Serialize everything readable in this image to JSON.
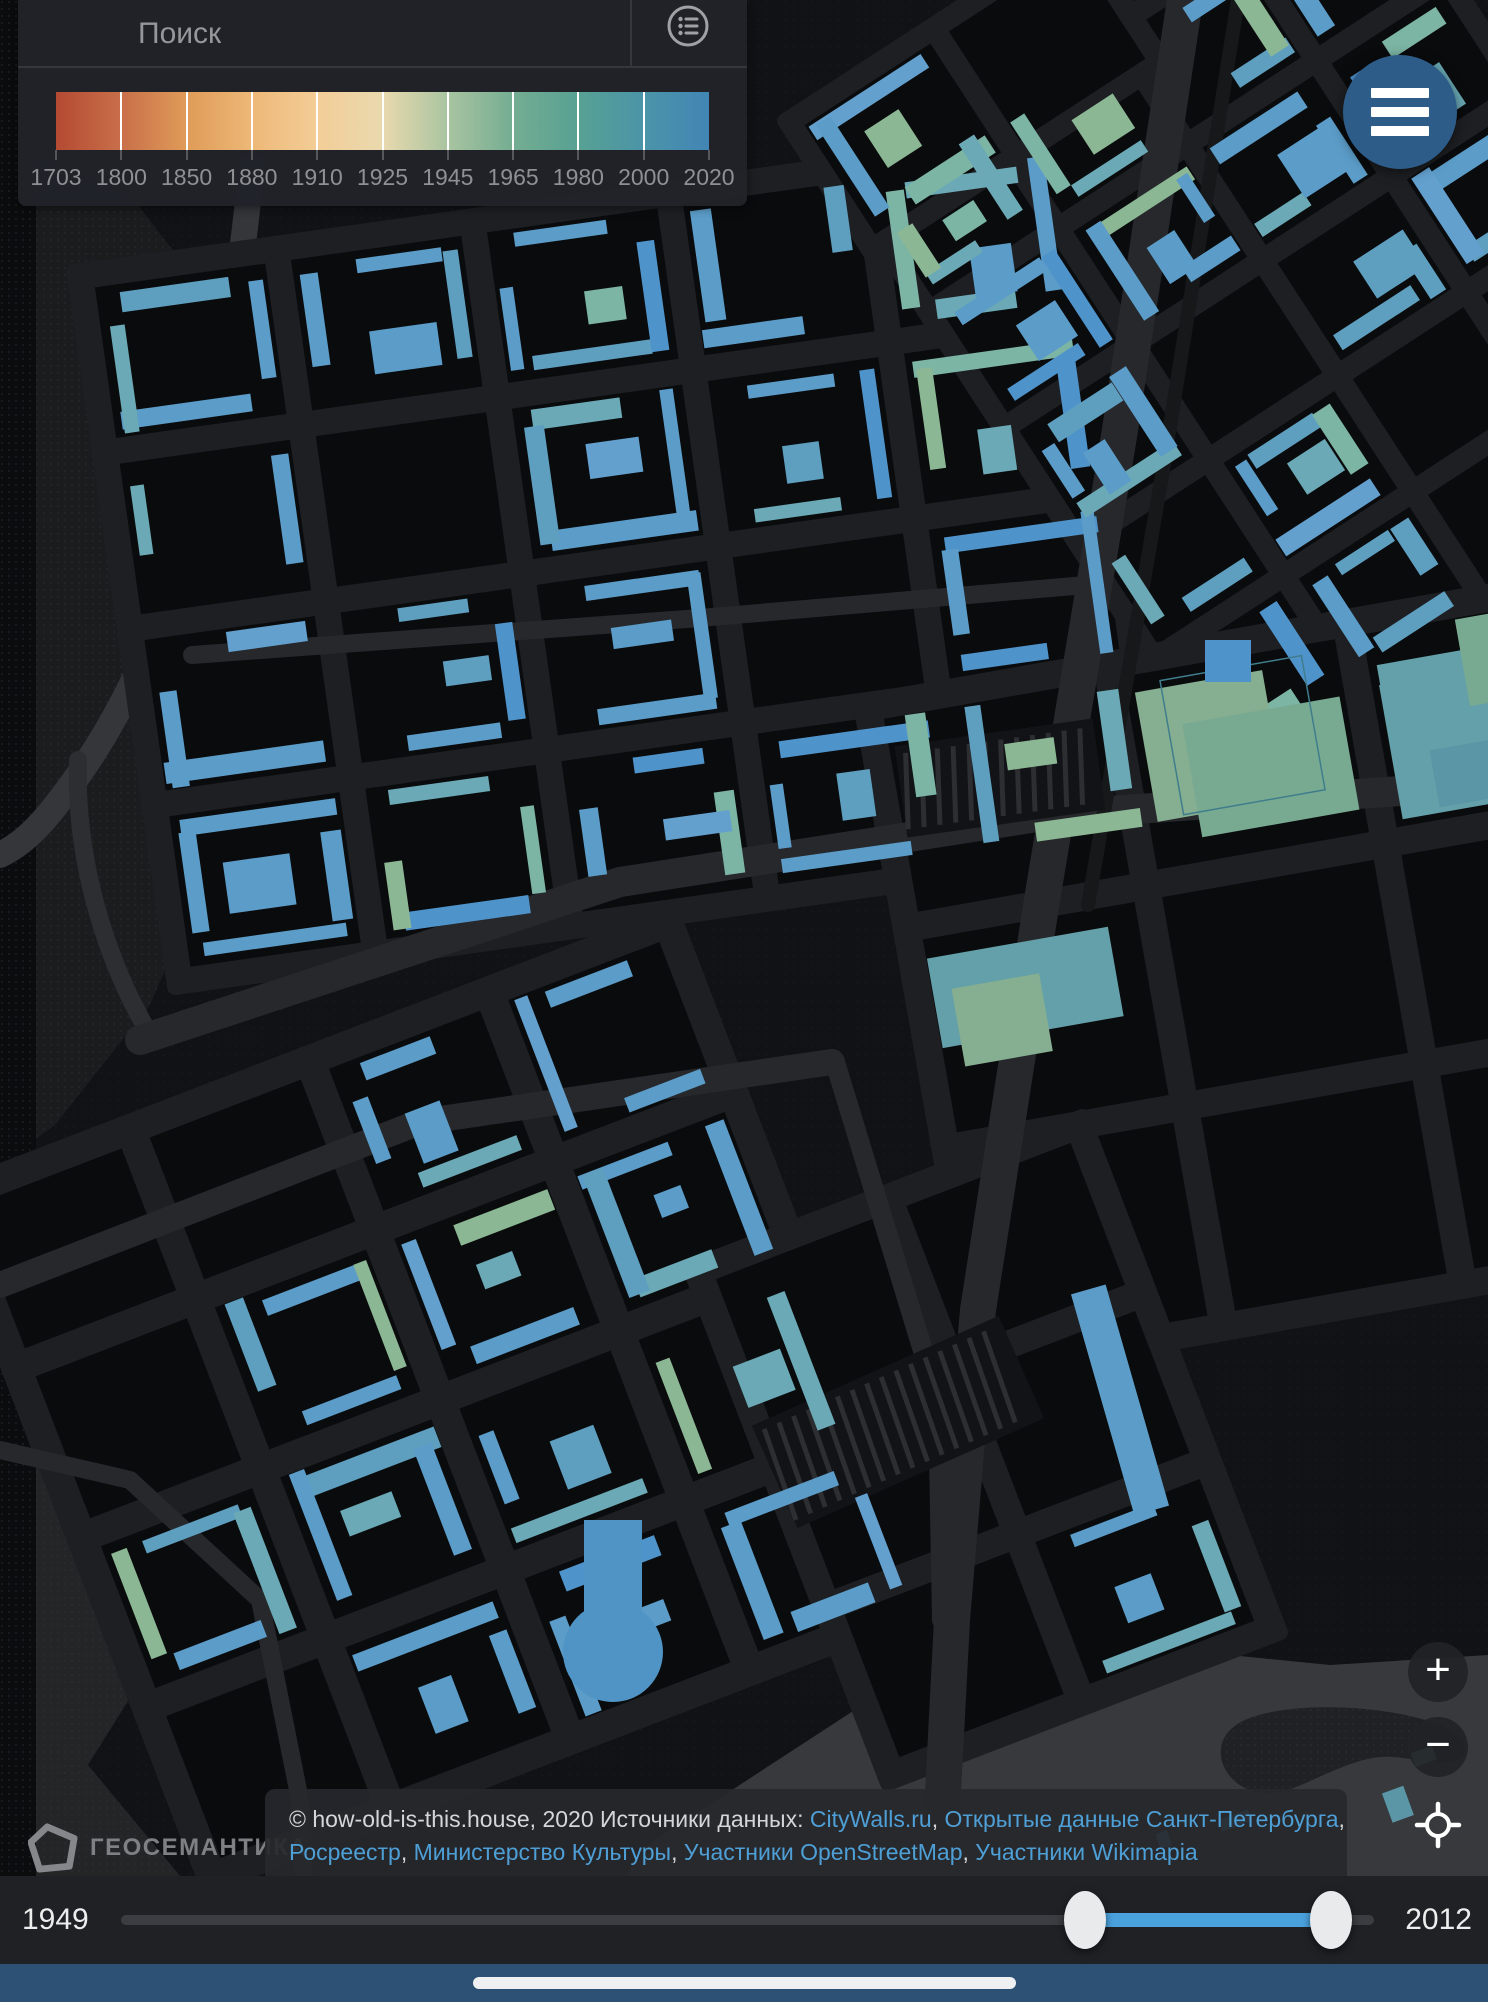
{
  "search": {
    "placeholder": "Поиск"
  },
  "legend": {
    "years": [
      "1703",
      "1800",
      "1850",
      "1880",
      "1910",
      "1925",
      "1945",
      "1965",
      "1980",
      "2000",
      "2020"
    ],
    "gradient": [
      "#b44a32",
      "#c96f4a",
      "#e09b58",
      "#edb877",
      "#f3cd97",
      "#e9d9ae",
      "#a9c4a0",
      "#74ad92",
      "#57a193",
      "#4b94a8",
      "#4285b5"
    ]
  },
  "controls": {
    "zoom_in": "+",
    "zoom_out": "−"
  },
  "menu_button": {
    "color": "#2d5c88"
  },
  "logo": {
    "text": "ГЕОСЕМАНТИКА"
  },
  "attribution": {
    "lines": [
      [
        {
          "t": "© how-old-is-this.house, 2020 Источники данных: ",
          "link": false
        },
        {
          "t": "CityWalls.ru",
          "link": true
        },
        {
          "t": ", ",
          "link": false
        },
        {
          "t": "Открытые данные Санкт-Петербурга",
          "link": true
        },
        {
          "t": ",",
          "link": false
        }
      ],
      [
        {
          "t": "Росреестр",
          "link": true
        },
        {
          "t": ", ",
          "link": false
        },
        {
          "t": "Министерство Культуры",
          "link": true
        },
        {
          "t": ", ",
          "link": false
        },
        {
          "t": "Участники OpenStreetMap",
          "link": true
        },
        {
          "t": ", ",
          "link": false
        },
        {
          "t": "Участники Wikimapia",
          "link": true
        }
      ]
    ]
  },
  "timeline": {
    "min_label": "1949",
    "max_label": "2012",
    "handle_pct": [
      76.9,
      96.6
    ],
    "active_color": "#4aa2dd"
  },
  "home_strip_color": "#2d5174",
  "map": {
    "seed": 1337,
    "colors": {
      "base": "#111215",
      "backing": "#1d1f22",
      "block": "#0a0b0d",
      "road": "#26282c",
      "rail": "#17181a",
      "hatch_bg": "#121316",
      "hatch_line": "#2c2e31",
      "dots": "#2e3033",
      "buildings": [
        "#5b9cc8",
        "#5e9fc0",
        "#6aa9b5",
        "#7cb5a4",
        "#4f93cb",
        "#8cb794",
        "#63a0ce"
      ],
      "building_weights": [
        46,
        16,
        12,
        8,
        8,
        5,
        5
      ],
      "industrial": [
        "#64a0a9",
        "#5a96a6",
        "#4f93c9",
        "#78aa92",
        "#86ae90",
        "#5b9cc8"
      ],
      "outline": "#3f7d8c"
    },
    "terrains": [
      {
        "pts": "0,140 130,195 235,330 272,560 238,800 150,1005 55,1125 0,1165",
        "fill": "#1a1c1e",
        "dots": true
      },
      {
        "pts": "0,1200 150,1262 232,1402 188,1605 88,1765 0,1805",
        "fill": "#232527",
        "dots": true
      },
      {
        "pts": "560,2002 640,1850 870,1700 1130,1645 1330,1665 1488,1655 1488,2002",
        "fill": "#38393c",
        "dots": false
      },
      {
        "pts": "0,1805 88,1765 200,1900 140,2002 0,2002",
        "fill": "#232527",
        "dots": true
      },
      {
        "pts": "0,0 36,0 36,2002 0,2002",
        "fill": "#0b0c0e",
        "dots": true
      }
    ],
    "ponds": [
      {
        "d": "M1245,1720 C1290,1700 1390,1705 1440,1725 C1480,1742 1470,1768 1430,1762 C1390,1756 1380,1752 1340,1768 C1300,1784 1280,1800 1250,1790 C1220,1780 1205,1738 1245,1720 Z",
        "fill": "#1f2124"
      }
    ],
    "bands": [
      {
        "d": "M252,165 C225,420 185,640 60,800 C30,840 10,850 0,855",
        "color": "#34363a",
        "w": 26
      },
      {
        "d": "M150,1035 C100,950 75,850 78,760",
        "color": "#2c2e31",
        "w": 18
      }
    ],
    "roads": [
      {
        "pts": "140,1040 620,882 1050,815 1488,785",
        "w": 30
      },
      {
        "pts": "1185,0 1120,430 1042,900 978,1310 952,1620 942,1812",
        "w": 36
      },
      {
        "pts": "0,1285 420,1122 832,1062",
        "w": 26
      },
      {
        "pts": "192,655 700,618 1086,585",
        "w": 18
      },
      {
        "pts": "835,1062 938,1400 942,1620",
        "w": 20
      },
      {
        "pts": "0,1450 130,1480 260,1600 300,1800 310,2002",
        "w": 18
      }
    ],
    "rail": {
      "pts": "1238,0 1163,470 1088,905",
      "w": 14
    },
    "yards": [
      {
        "cx": 1000,
        "cy": 778,
        "w": 200,
        "h": 92,
        "rot": -8
      },
      {
        "cx": 898,
        "cy": 1422,
        "w": 270,
        "h": 112,
        "rot": -24
      }
    ],
    "districts": [
      {
        "cx": 620,
        "cy": 560,
        "cols": 5,
        "rows": 4,
        "cw": 172,
        "ch": 152,
        "st": 26,
        "rot": -8,
        "empty": 0.12,
        "style": "perimeter"
      },
      {
        "cx": 1300,
        "cy": 318,
        "cols": 4,
        "rows": 5,
        "cw": 132,
        "ch": 116,
        "st": 22,
        "rot": -33,
        "empty": 0.15,
        "style": "perimeter"
      },
      {
        "cx": 975,
        "cy": 92,
        "cols": 2,
        "rows": 1,
        "cw": 150,
        "ch": 130,
        "st": 22,
        "rot": -33,
        "empty": 0.2,
        "style": "perimeter"
      },
      {
        "cx": 1285,
        "cy": 975,
        "cols": 3,
        "rows": 3,
        "cw": 215,
        "ch": 196,
        "st": 28,
        "rot": -10,
        "empty": 0.18,
        "style": "industrial"
      },
      {
        "cx": 440,
        "cy": 1400,
        "cols": 4,
        "rows": 4,
        "cw": 162,
        "ch": 152,
        "st": 30,
        "rot": -21,
        "empty": 0.1,
        "style": "perimeter"
      },
      {
        "cx": 985,
        "cy": 1450,
        "cols": 2,
        "rows": 3,
        "cw": 176,
        "ch": 152,
        "st": 28,
        "rot": -21,
        "empty": 0.25,
        "style": "perimeter"
      }
    ],
    "scatter": {
      "x": 900,
      "y": 1830,
      "w": 560,
      "h": 150,
      "n": 14,
      "rot": -20
    },
    "specials": {
      "circus": {
        "x": 613,
        "y": 1652,
        "r": 50,
        "stem_w": 58,
        "stem_h": 92,
        "color": "#4f94c4"
      },
      "strip": {
        "cx": 1120,
        "cy": 1400,
        "w": 36,
        "h": 230,
        "rot": -16,
        "color": "#5b9cc8"
      },
      "block": {
        "x": 1205,
        "y": 640,
        "w": 46,
        "h": 42,
        "color": "#4f93cb"
      }
    }
  }
}
